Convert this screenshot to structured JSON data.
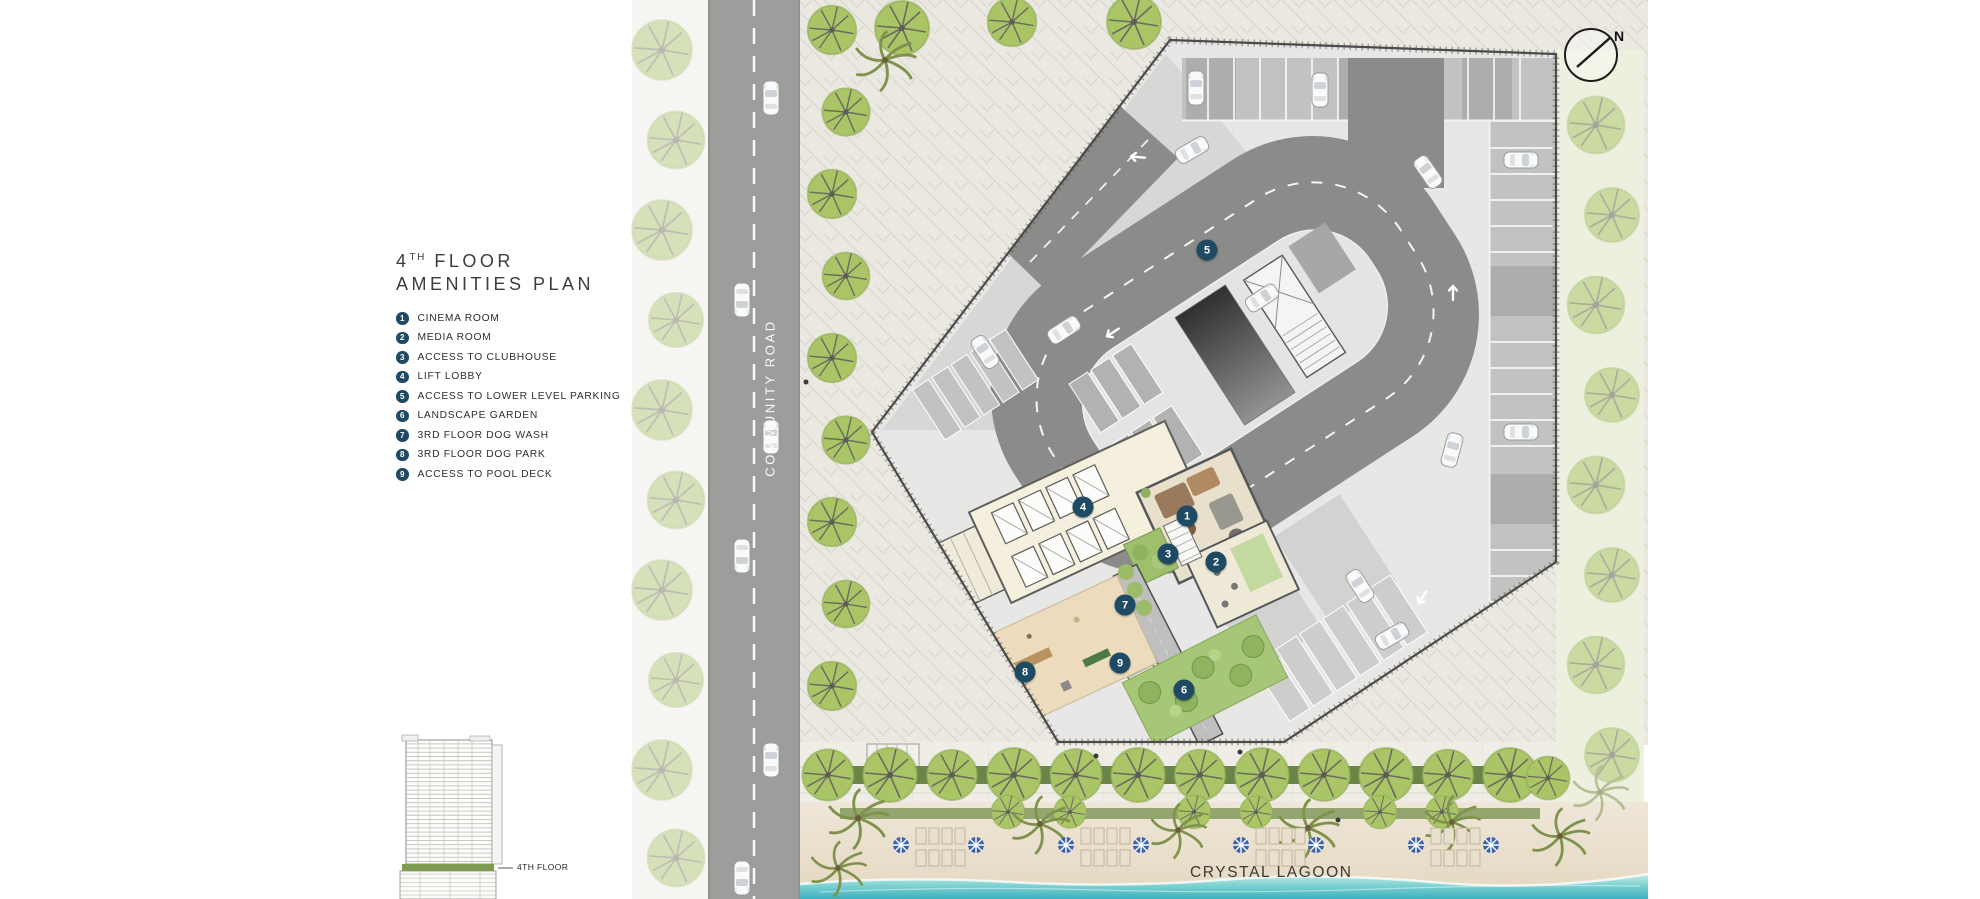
{
  "header": {
    "floor_number": "4",
    "floor_ordinal": "TH",
    "floor_word": "FLOOR",
    "subtitle": "AMENITIES PLAN"
  },
  "legend": {
    "items": [
      {
        "number": "1",
        "label": "CINEMA ROOM"
      },
      {
        "number": "2",
        "label": "MEDIA ROOM"
      },
      {
        "number": "3",
        "label": "ACCESS TO CLUBHOUSE"
      },
      {
        "number": "4",
        "label": "LIFT LOBBY"
      },
      {
        "number": "5",
        "label": "ACCESS TO LOWER LEVEL PARKING"
      },
      {
        "number": "6",
        "label": "LANDSCAPE GARDEN"
      },
      {
        "number": "7",
        "label": "3RD FLOOR DOG WASH"
      },
      {
        "number": "8",
        "label": "3RD FLOOR DOG PARK"
      },
      {
        "number": "9",
        "label": "ACCESS TO POOL DECK"
      }
    ]
  },
  "plan": {
    "markers": [
      {
        "number": "1"
      },
      {
        "number": "2"
      },
      {
        "number": "3"
      },
      {
        "number": "4"
      },
      {
        "number": "5"
      },
      {
        "number": "6"
      },
      {
        "number": "7"
      },
      {
        "number": "8"
      },
      {
        "number": "9"
      }
    ]
  },
  "labels": {
    "community_road": "COMMUNITY ROAD",
    "crystal_lagoon": "CRYSTAL LAGOON",
    "compass_north": "N",
    "elevation_floor": "4TH FLOOR"
  },
  "colors": {
    "marker_badge": "#1f4a63",
    "community_road": "#9d9d9b",
    "loop_road": "#8b8b89",
    "site_deck": "#e7e7e5",
    "building_floor": "#f5efde",
    "tree_green": "#a9c566",
    "hedge_green": "#6b8449",
    "garden_green": "#a6c678",
    "dog_park_tan": "#ecdcbd",
    "beach_sand": "#ebe2d2",
    "lagoon_water": "#4db9c3"
  }
}
